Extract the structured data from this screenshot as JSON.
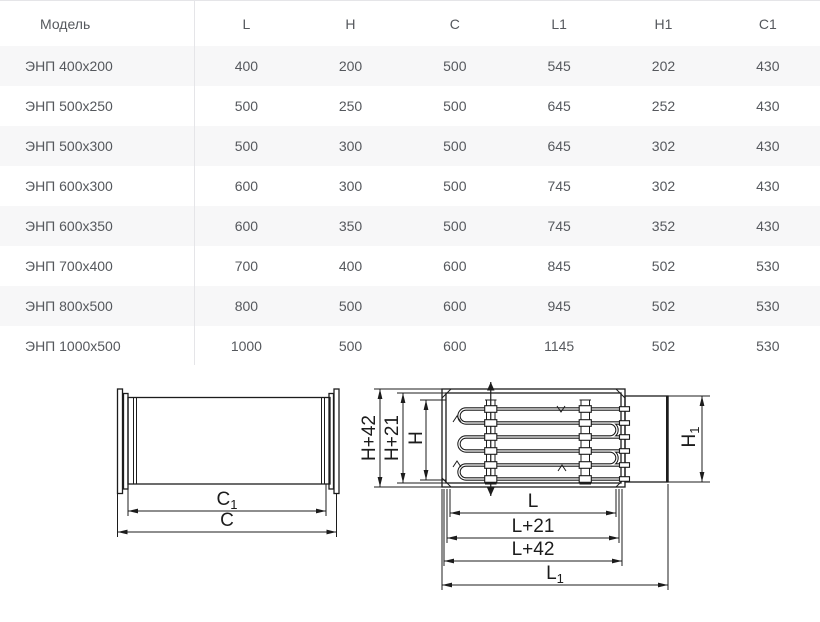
{
  "colors": {
    "background": "#ffffff",
    "row_stripe": "#f7f7f8",
    "table_border": "#e5e5e8",
    "table_text": "#55585d",
    "drawing_line": "#1c1c1c"
  },
  "table": {
    "columns": [
      "Модель",
      "L",
      "H",
      "C",
      "L1",
      "H1",
      "C1"
    ],
    "rows": [
      {
        "model": "ЭНП 400х200",
        "values": [
          400,
          200,
          500,
          545,
          202,
          430
        ]
      },
      {
        "model": "ЭНП 500х250",
        "values": [
          500,
          250,
          500,
          645,
          252,
          430
        ]
      },
      {
        "model": "ЭНП 500х300",
        "values": [
          500,
          300,
          500,
          645,
          302,
          430
        ]
      },
      {
        "model": "ЭНП 600х300",
        "values": [
          600,
          300,
          500,
          745,
          302,
          430
        ]
      },
      {
        "model": "ЭНП 600х350",
        "values": [
          600,
          350,
          500,
          745,
          352,
          430
        ]
      },
      {
        "model": "ЭНП 700х400",
        "values": [
          700,
          400,
          600,
          845,
          502,
          530
        ]
      },
      {
        "model": "ЭНП 800х500",
        "values": [
          800,
          500,
          600,
          945,
          502,
          530
        ]
      },
      {
        "model": "ЭНП 1000х500",
        "values": [
          1000,
          500,
          600,
          1145,
          502,
          530
        ]
      }
    ]
  },
  "side_view": {
    "c1_base": "C",
    "c1_sub": "1",
    "c": "C"
  },
  "front_view": {
    "h42": "H+42",
    "h21": "H+21",
    "h": "H",
    "h1_base": "H",
    "h1_sub": "1",
    "l": "L",
    "l21": "L+21",
    "l42": "L+42",
    "l1_base": "L",
    "l1_sub": "1"
  }
}
